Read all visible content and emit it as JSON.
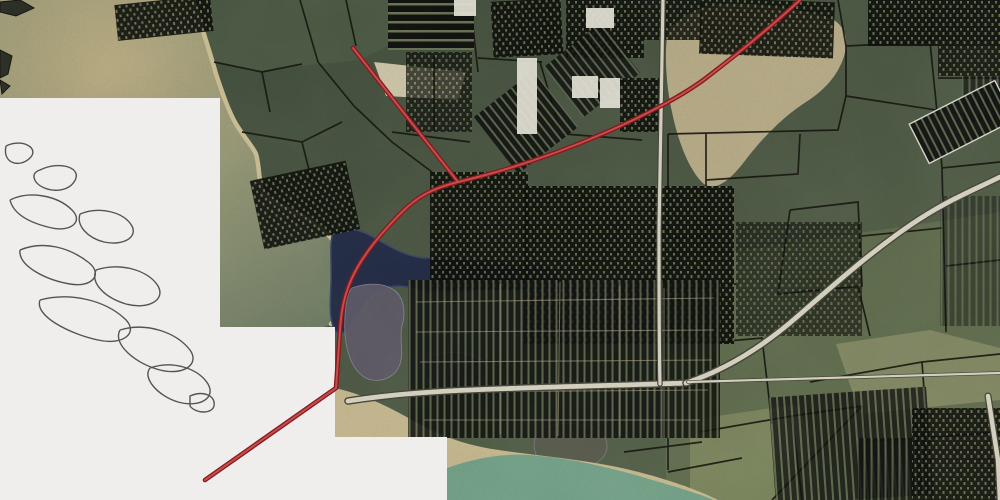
{
  "app": {
    "type": "gis-aerial-map-view",
    "description": "Aerial imagery basemap with black tax-parcel boundary overlay, a red highlighted route, gray roads, water bodies, and white no-imagery regions containing marsh outline linework"
  },
  "canvas": {
    "width": 1000,
    "height": 500
  },
  "palette": {
    "forest": "#4b5743",
    "forest_dark": "#3e4a39",
    "no_data": "#efeeec",
    "squiggle": "#45443f",
    "bay_tan": "#b9ab80",
    "bay_mid": "#8d9272",
    "bay_deep": "#6d7a62",
    "beach": "#cbbd93",
    "lake": "#232c45",
    "lake_stroke": "#3b4768",
    "marsh": "#5e5a68",
    "marsh_dark": "#4a4452",
    "shore_water": "#74a188",
    "parcel_line": "#15150f",
    "street": "#b4a98a",
    "building": "#e3e0d4",
    "road_under": "#45453b",
    "road_over": "#d7d3c1",
    "route_outer": "#8a181d",
    "route_inner": "#c14f4d",
    "cluster_bg": "#0e0f0c",
    "cluster_cell": "#66704f"
  },
  "patterns": [
    {
      "id": "p-dense",
      "w": 7,
      "h": 9,
      "bg": "#0e0f0c",
      "fg": "#66704f",
      "cells": [
        [
          1,
          1,
          2,
          2.5
        ],
        [
          4.5,
          5,
          2,
          3
        ]
      ]
    },
    {
      "id": "p-strips",
      "w": 7,
      "h": 7,
      "bg": "#101110",
      "fg": "#5d674c",
      "cells": [
        [
          2.5,
          0,
          2,
          7
        ]
      ]
    },
    {
      "id": "p-rows",
      "w": 8,
      "h": 9,
      "bg": "#0e0f0c",
      "fg": "#6a7454",
      "cells": [
        [
          0,
          3,
          8,
          2.5
        ]
      ]
    }
  ],
  "layers": {
    "patches": [
      {
        "name": "north-shore-land",
        "d": "M196,0 L390,0 L400,40 L360,60 L300,66 L256,72 L214,62 Z",
        "fill": "#4f5c46",
        "o": 0.7
      },
      {
        "name": "northeast-sand-clearing",
        "d": "M668,30 C680,16 700,6 724,4 C756,2 792,8 824,16 C840,20 848,32 846,48 C842,70 828,88 806,102 C784,116 762,138 744,162 C730,180 716,192 704,184 C690,172 678,142 672,112 C666,86 664,52 668,30 Z",
        "fill": "#c2b48e",
        "o": 0.9
      },
      {
        "name": "center-sand-patch",
        "d": "M374,62 L466,72 L458,100 L386,96 Z",
        "fill": "#d9d0b2",
        "o": 0.9
      },
      {
        "name": "southeast-olive-fields",
        "d": "M666,262 L1000,212 L1000,500 L666,500 Z",
        "fill": "#6e7a54",
        "o": 0.5
      },
      {
        "name": "south-green-field",
        "d": "M690,420 L800,404 L820,500 L690,500 Z",
        "fill": "#8a9565",
        "o": 0.6
      },
      {
        "name": "east-tan-field",
        "d": "M836,344 L930,330 L1000,348 L1000,400 L860,414 Z",
        "fill": "#9f9e74",
        "o": 0.55
      }
    ],
    "bay_water_d": "M0,0 L193,0 C202,28 210,52 216,74 C222,92 228,110 236,124 C246,140 253,147 256,154 C260,168 258,182 264,194 C274,204 290,209 303,216 C319,225 333,239 347,255 C355,265 356,275 353,285 C349,300 341,314 331,324 L322,328 L220,327 L220,98 L0,98 Z",
    "shoreline_d": "M193,0 C202,28 210,52 216,74 C222,92 228,110 236,124 C246,140 253,147 256,154 C260,168 258,182 264,194 C274,204 290,209 303,216 C319,225 333,239 347,255 C355,265 356,275 353,285 C349,300 341,314 331,324",
    "lake_d": "M333,232 C347,226 362,230 375,238 C390,247 403,254 417,257 C432,260 447,255 461,259 C476,263 491,261 505,263 C519,265 532,262 545,266 C556,269 561,277 557,283 C546,290 530,287 515,289 C500,291 484,291 468,291 C450,291 433,295 419,290 C404,285 390,284 377,292 C366,299 358,312 351,324 C346,333 339,337 334,329 C329,318 330,300 331,284 C332,266 329,244 333,232 Z",
    "marsh_shapes": [
      {
        "d": "M352,288 C366,283 382,282 394,290 C404,297 406,312 402,326 C399,338 404,352 400,364 C396,376 384,382 372,380 C360,378 352,366 348,352 C344,338 344,320 346,306 C347,298 348,292 352,288 Z",
        "fill": "#5e5a68",
        "o": 0.9
      },
      {
        "d": "M430,356 C450,350 470,352 482,360 C490,366 488,378 478,384 C464,392 444,392 432,384 C424,378 422,362 430,356 Z",
        "fill": "#4a4452",
        "o": 0.8
      },
      {
        "d": "M540,430 C560,420 586,422 600,432 C612,442 608,458 594,464 C576,472 552,470 540,460 C532,452 532,438 540,430 Z",
        "fill": "#5c5a50",
        "o": 0.7
      }
    ],
    "bottom_beach_d": "M335,388 C362,394 388,406 412,420 C436,434 462,444 492,449 C530,455 572,458 612,466 C652,474 692,487 718,500 L447,500 L447,437 L335,437 Z",
    "bottom_water_d": "M447,468 C478,457 508,452 540,456 C572,459 602,466 632,474 C662,483 692,491 714,500 L447,500 Z",
    "parcel_lines": [
      "M838,0 L846,46 L846,96",
      "M846,46 L930,42 L934,0",
      "M846,96 L1000,120",
      "M930,42 L938,122",
      "M846,96 L838,130 L668,134",
      "M938,78 L1000,78",
      "M938,122 L942,168 L1000,162",
      "M706,134 L706,334",
      "M668,134 L668,238",
      "M706,180 L798,174 L800,134",
      "M790,210 L858,202 L862,286 L778,294 L790,210",
      "M862,236 L942,228",
      "M942,168 L946,332",
      "M858,286 L870,336",
      "M668,238 L706,236",
      "M214,62 L262,72 L302,64",
      "M262,72 L270,112",
      "M300,0 L318,62 L354,106",
      "M242,132 L302,142 L342,122",
      "M354,106 L392,142 L432,172",
      "M302,142 L312,182",
      "M470,0 L478,72",
      "M478,58 L542,62",
      "M392,132 L470,142",
      "M434,56 L434,130",
      "M540,62 L560,130",
      "M716,342 L762,338 L772,424",
      "M700,432 L792,416 L802,500",
      "M668,472 L742,458",
      "M792,416 L862,406 L870,500",
      "M862,442 L922,438",
      "M810,382 L922,362 L1000,354",
      "M922,362 L932,500",
      "M772,500 L862,406",
      "M922,438 L1000,432",
      "M624,452 L702,442",
      "M668,392 L668,470",
      "M564,134 L642,140",
      "M346,0 L356,46",
      "M870,46 L870,0",
      "M1000,260 L946,266",
      "M706,287 L736,284"
    ],
    "clusters": [
      {
        "x": 116,
        "y": 0,
        "w": 96,
        "h": 36,
        "rot": -6,
        "p": "p-dense",
        "o": 0.92
      },
      {
        "x": 388,
        "y": 0,
        "w": 86,
        "h": 50,
        "rot": 0,
        "p": "p-rows",
        "o": 0.95
      },
      {
        "x": 406,
        "y": 52,
        "w": 66,
        "h": 80,
        "rot": 0,
        "p": "p-dense",
        "o": 0.72
      },
      {
        "x": 492,
        "y": 0,
        "w": 70,
        "h": 56,
        "rot": -3,
        "p": "p-dense",
        "o": 0.92
      },
      {
        "x": 566,
        "y": 0,
        "w": 78,
        "h": 58,
        "rot": 0,
        "p": "p-dense",
        "o": 0.9
      },
      {
        "x": 644,
        "y": 0,
        "w": 58,
        "h": 40,
        "rot": 0,
        "p": "p-dense",
        "o": 0.85
      },
      {
        "x": 488,
        "y": 86,
        "w": 76,
        "h": 72,
        "rot": -38,
        "p": "p-strips",
        "o": 0.9
      },
      {
        "x": 556,
        "y": 38,
        "w": 72,
        "h": 64,
        "rot": -38,
        "p": "p-strips",
        "o": 0.85
      },
      {
        "x": 620,
        "y": 78,
        "w": 42,
        "h": 54,
        "rot": 0,
        "p": "p-dense",
        "o": 0.9
      },
      {
        "x": 700,
        "y": 0,
        "w": 134,
        "h": 56,
        "rot": 2,
        "p": "p-dense",
        "o": 0.9
      },
      {
        "x": 868,
        "y": 0,
        "w": 132,
        "h": 46,
        "rot": 0,
        "p": "p-dense",
        "o": 0.9
      },
      {
        "x": 938,
        "y": 46,
        "w": 62,
        "h": 30,
        "rot": 0,
        "p": "p-dense",
        "o": 0.8
      },
      {
        "x": 962,
        "y": 76,
        "w": 38,
        "h": 46,
        "rot": 0,
        "p": "p-strips",
        "o": 0.7
      },
      {
        "x": 914,
        "y": 100,
        "w": 96,
        "h": 44,
        "rot": -27,
        "p": "p-strips",
        "o": 0.92,
        "stroke": "#e8e4d8"
      },
      {
        "x": 256,
        "y": 170,
        "w": 98,
        "h": 70,
        "rot": -12,
        "p": "p-dense",
        "o": 0.9
      },
      {
        "x": 430,
        "y": 172,
        "w": 98,
        "h": 118,
        "rot": 0,
        "p": "p-dense",
        "o": 0.9
      },
      {
        "x": 524,
        "y": 186,
        "w": 210,
        "h": 158,
        "rot": 0,
        "p": "p-dense",
        "o": 0.92
      },
      {
        "x": 736,
        "y": 222,
        "w": 126,
        "h": 114,
        "rot": 0,
        "p": "p-dense",
        "o": 0.6
      },
      {
        "x": 408,
        "y": 280,
        "w": 312,
        "h": 158,
        "rot": 0,
        "p": "p-strips",
        "o": 0.88
      },
      {
        "x": 772,
        "y": 392,
        "w": 158,
        "h": 108,
        "rot": -4,
        "p": "p-strips",
        "o": 0.8
      },
      {
        "x": 912,
        "y": 408,
        "w": 88,
        "h": 92,
        "rot": 0,
        "p": "p-dense",
        "o": 0.85
      },
      {
        "x": 858,
        "y": 438,
        "w": 54,
        "h": 62,
        "rot": 0,
        "p": "p-strips",
        "o": 0.8
      },
      {
        "x": 940,
        "y": 196,
        "w": 60,
        "h": 130,
        "rot": 0,
        "p": "p-strips",
        "o": 0.45
      }
    ],
    "streets": [
      "M416,302 L714,298",
      "M416,332 L714,330",
      "M420,362 L712,360",
      "M430,392 L708,390",
      "M424,420 L700,420",
      "M500,284 L500,434",
      "M560,282 L558,436",
      "M620,286 L620,436",
      "M664,288 L664,438"
    ],
    "buildings": [
      {
        "x": 454,
        "y": 0,
        "w": 22,
        "h": 16
      },
      {
        "x": 572,
        "y": 76,
        "w": 26,
        "h": 22
      },
      {
        "x": 600,
        "y": 78,
        "w": 20,
        "h": 30
      },
      {
        "x": 586,
        "y": 8,
        "w": 28,
        "h": 20
      },
      {
        "x": 517,
        "y": 58,
        "w": 20,
        "h": 76
      }
    ],
    "roads": [
      {
        "name": "coastal-highway",
        "d": "M348,401 C380,396 420,392 470,390 C540,387 600,386 686,383",
        "uw": 7.5,
        "ow": 4.8
      },
      {
        "name": "diagonal-highway",
        "d": "M686,383 C728,369 766,344 798,316 C838,281 878,246 918,220 C952,198 978,188 1000,177",
        "uw": 7.5,
        "ow": 4.8
      },
      {
        "name": "north-south-road",
        "d": "M663,0 C662,60 660,140 659,230 C659,300 659,345 660,384",
        "uw": 5.5,
        "ow": 3.2
      },
      {
        "name": "east-spur-road",
        "d": "M688,382 L1000,373",
        "uw": 3.6,
        "ow": 2.2
      },
      {
        "name": "edge-road",
        "d": "M988,396 L998,460 L1000,500",
        "uw": 7,
        "ow": 4.5
      }
    ],
    "no_data_d": "M0,98 L220,98 L220,327 L335,327 L335,437 L447,437 L447,500 L0,500 Z",
    "squiggles": [
      "M6,146 C22,138 40,148 30,158 C20,168 2,164 6,146",
      "M40,170 C60,160 84,168 74,182 C66,194 44,192 36,182 C32,176 34,172 40,170",
      "M10,200 C30,190 58,196 72,210 C84,222 70,232 52,228 C34,224 14,216 10,200",
      "M80,214 C100,206 124,212 132,226 C138,238 122,246 104,242 C88,238 76,226 80,214",
      "M20,250 C44,240 70,248 88,262 C104,274 92,288 70,284 C46,280 18,266 20,250",
      "M96,270 C120,262 148,270 158,286 C166,300 148,310 126,304 C106,298 90,284 96,270",
      "M40,300 C70,292 104,300 124,318 C140,332 124,346 98,340 C70,334 34,316 40,300",
      "M120,330 C146,322 176,332 190,350 C200,364 184,376 160,370 C136,364 112,344 120,330",
      "M150,368 C172,360 198,368 208,384 C216,398 200,408 178,402 C158,396 142,378 150,368",
      "M190,396 C204,390 216,396 214,406 C212,414 196,414 190,406 Z"
    ],
    "edge_shapes": [
      {
        "d": "M0,2 L20,0 L34,8 L16,16 L0,12 Z"
      },
      {
        "d": "M0,50 L12,56 L8,74 L0,78 Z"
      },
      {
        "d": "M0,80 L10,86 L2,94 Z"
      }
    ],
    "route": {
      "main_d": "M800,0 C772,26 740,52 706,78 C664,110 560,158 458,182 C430,189 416,198 402,212 C382,232 362,256 352,278 C344,295 341,312 340,330 L336,388 L205,480",
      "branch_d": "M353,48 L458,182",
      "width_outer": 4.6,
      "width_inner": 2
    }
  }
}
